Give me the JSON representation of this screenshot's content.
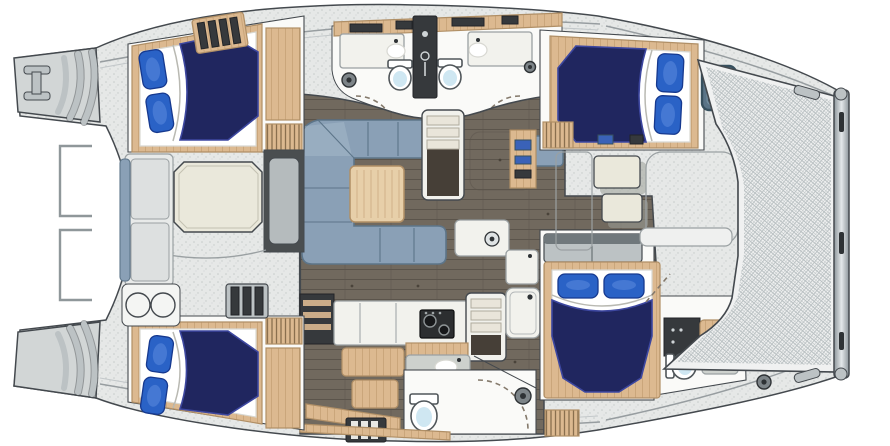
{
  "meta": {
    "title": "Catamaran yacht interior layout floor plan, top-down view, bow to the right",
    "canvas": {
      "width": 890,
      "height": 446
    },
    "visible_text": []
  },
  "scene": {
    "type": "floor-plan",
    "vessel": "sailing catamaran",
    "orientation": "bow right, twin transom steps left, trampoline at bow",
    "counts": {
      "cabins": 4,
      "double_berths": 4,
      "pillows_per_berth": 2,
      "toilets": 4,
      "wash_basins": 4,
      "companionway_stairs": 2,
      "trampolines": 1,
      "deck_hatches": 1
    },
    "areas": [
      {
        "id": "port-transom",
        "label": "Port transom swim steps with boarding fitting"
      },
      {
        "id": "starboard-transom",
        "label": "Starboard transom swim steps"
      },
      {
        "id": "aft-cockpit",
        "label": "Aft cockpit with bench seating and octagonal cream table"
      },
      {
        "id": "cockpit-basin-unit",
        "label": "Cockpit unit with twin round basins"
      },
      {
        "id": "port-aft-cabin",
        "label": "Port aft double cabin, navy duvet, two blue pillows"
      },
      {
        "id": "starboard-aft-cabin",
        "label": "Starboard aft double cabin, navy duvet, two blue pillows"
      },
      {
        "id": "twin-heads",
        "label": "Twin washrooms with toilets, basins and central shower column"
      },
      {
        "id": "salon",
        "label": "Salon with U-shaped blue-grey settee and square wood table"
      },
      {
        "id": "port-companionway",
        "label": "Steps down into port hull"
      },
      {
        "id": "starboard-companionway",
        "label": "Steps down into starboard hull"
      },
      {
        "id": "nav-area",
        "label": "Navigator seat with instrument locker"
      },
      {
        "id": "galley",
        "label": "Galley with two-burner stove, sink unit and refrigerator"
      },
      {
        "id": "dinette",
        "label": "Hull bench seating"
      },
      {
        "id": "starboard-head",
        "label": "Starboard head with toilet and curved shower door"
      },
      {
        "id": "port-forward-cabin",
        "label": "Port forward double cabin with blue-grey deck hatch"
      },
      {
        "id": "starboard-forward-cabin",
        "label": "Starboard forward double cabin with en-suite toilet and basin"
      },
      {
        "id": "foredeck",
        "label": "Foredeck seats and locker panels"
      },
      {
        "id": "trampoline",
        "label": "Bow trampoline net"
      },
      {
        "id": "bow-crossbeam",
        "label": "Bow crossbeam with fittings"
      }
    ],
    "bedding": "navy duvet with folded white sheet and royal-blue pillows"
  },
  "colors": {
    "pageBg": "#ffffff",
    "outline": "#44494e",
    "deck": "#e6e8e7",
    "speckleDot": "#c6cbca",
    "hullGray": "#d2d6d6",
    "stepGray": "#bcc2c4",
    "benchGray": "#e8eae9",
    "cushionGray": "#dde0e0",
    "rail": "#8f979a",
    "floor": "#71695e",
    "plankLine": "#5b544b",
    "cabinSole": "#fafaf8",
    "woodTan": "#dcb990",
    "woodGrain": "#c09a6f",
    "woodTanDark": "#b08f66",
    "coilLine": "#8a6f4e",
    "counter": "#f2f2ed",
    "counterEdge": "#9aa0a2",
    "navy": "#20265f",
    "navyEdge": "#3d47a0",
    "pillowBlue": "#2a62c6",
    "pillowDark": "#16398f",
    "pillowShine": "#5b8ade",
    "sofaBlue": "#8aa0b6",
    "sofaLight": "#a9bccb",
    "sofaEdge": "#5d7589",
    "tableWood": "#e7cfa9",
    "cream": "#eae8db",
    "creamShadow": "#b9b7a8",
    "darkCabinet": "#36393c",
    "stove": "#2c2e30",
    "burner": "#17181a",
    "burnerRing": "#8e9496",
    "bowl": "#cfe7f2",
    "toiletEdge": "#50565a",
    "meshBg": "#f0f1f1",
    "meshLine": "#b9c0c2",
    "beamLight": "#e4e8ea",
    "beamDark": "#8d969b",
    "window": "#5a7487",
    "windowFrame": "#37505e",
    "doorArc": "#84796b",
    "fitting": "#7d8488",
    "fittingDark": "#2e3235",
    "shadow": "#9b9f98",
    "navBlue": "#3a62b8"
  }
}
